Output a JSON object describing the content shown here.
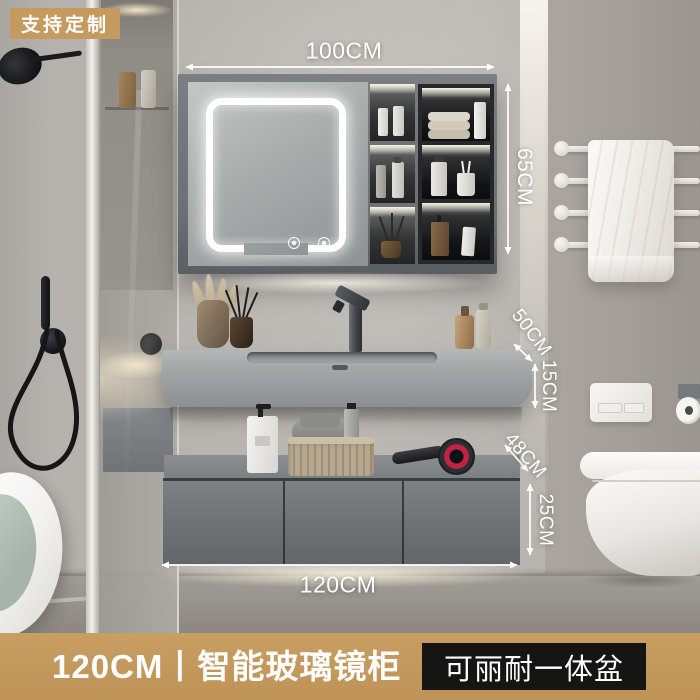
{
  "badge": {
    "label": "支持定制"
  },
  "dimensions": {
    "cabinet_width": "100CM",
    "cabinet_height": "65CM",
    "counter_depth": "50CM",
    "counter_height": "15CM",
    "drawer_depth": "48CM",
    "drawer_height": "25CM",
    "vanity_width": "120CM"
  },
  "mirror": {
    "clock_time": "13:12"
  },
  "footer": {
    "product_title": "120CM丨智能玻璃镜柜",
    "basin_tag": "可丽耐一体盆"
  },
  "colors": {
    "accent_gold": "#c49a5e",
    "tag_background": "#161514",
    "annotation_white": "#ffffff",
    "dryer_ring": "#c22248"
  }
}
